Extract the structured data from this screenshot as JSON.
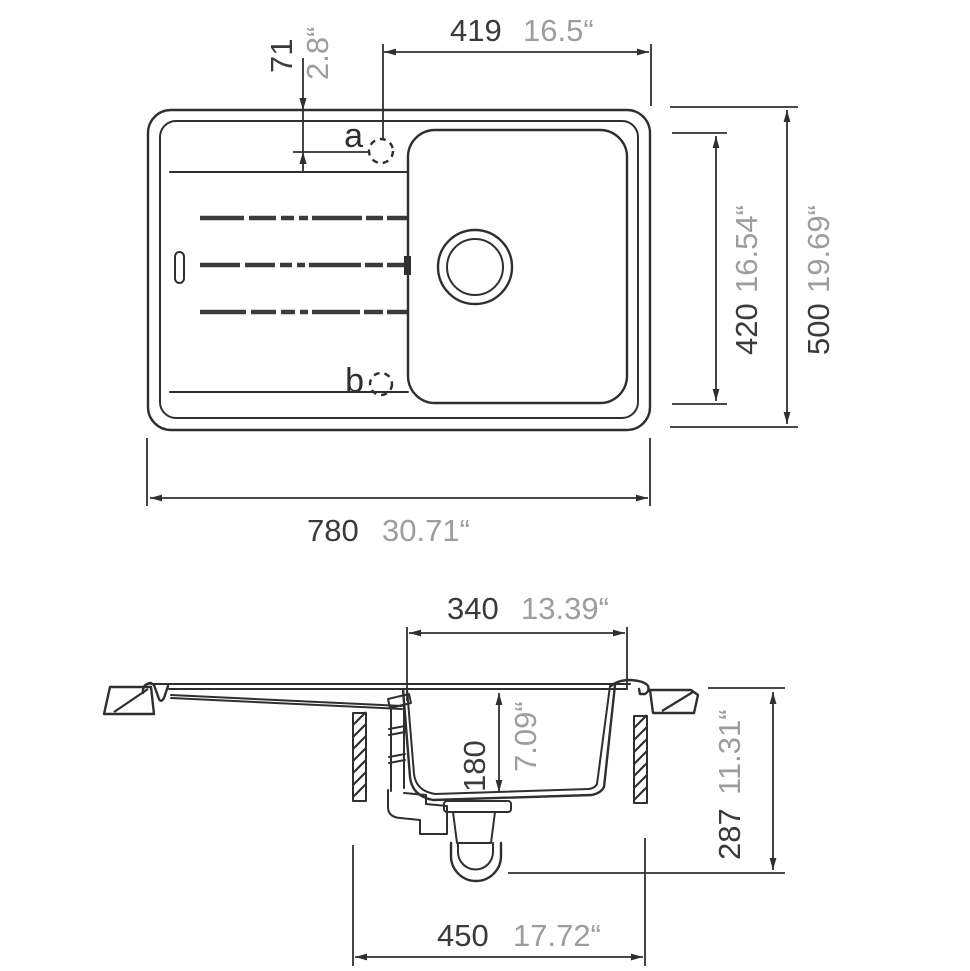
{
  "colors": {
    "background": "#ffffff",
    "line": "#2f2f2f",
    "mm_text": "#3a3a3a",
    "inch_text": "#9d9d9d"
  },
  "top_view": {
    "hole_labels": {
      "a": "a",
      "b": "b"
    },
    "dims": {
      "faucet_offset": {
        "mm": "71",
        "inch": "2.8“"
      },
      "faucet_to_edge": {
        "mm": "419",
        "inch": "16.5“"
      },
      "bowl_length": {
        "mm": "420",
        "inch": "16.54“"
      },
      "overall_width": {
        "mm": "500",
        "inch": "19.69“"
      },
      "overall_length": {
        "mm": "780",
        "inch": "30.71“"
      }
    }
  },
  "section_view": {
    "dims": {
      "bowl_top_width": {
        "mm": "340",
        "inch": "13.39“"
      },
      "bowl_depth": {
        "mm": "180",
        "inch": "7.09“"
      },
      "installation_depth": {
        "mm": "287",
        "inch": "11.31“"
      },
      "cabinet_width": {
        "mm": "450",
        "inch": "17.72“"
      }
    }
  }
}
